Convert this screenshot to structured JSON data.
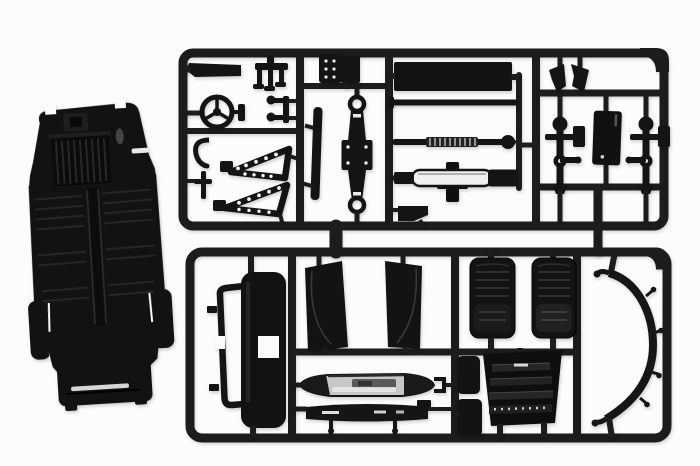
{
  "scene": {
    "type": "product-photo",
    "subject": "black plastic model-kit sprue (parts tree) with a separate chassis floor pan part on the left",
    "background_color": "#fcfcfd",
    "colors": {
      "plastic": "#141414",
      "plastic_deep": "#0c0c0c",
      "runner": "#1c1c1c",
      "panel": "#121212",
      "highlight_grey": "#383838",
      "chrome_base": "#c7c7c7",
      "chrome_streak": "#eaeaea",
      "white_detail": "#e9e9e9",
      "silver_stripe": "#d6d6d6"
    },
    "sprue": {
      "sections": 2,
      "top_section_parts": [
        "exhaust-bar",
        "pedal-cluster",
        "steering-wheel",
        "steering-linkage",
        "wishbone",
        "pin-bracket",
        "a-frame-ladder-1",
        "a-frame-ladder-2",
        "engine-block",
        "side-strip",
        "leaf-spring-axle",
        "side-sill-panel",
        "tie-rod",
        "coil-spring-rod",
        "shock-absorber",
        "mount-bracket",
        "wing-clip-left",
        "wing-clip-right",
        "kingpin-upright-left",
        "kingpin-upright-right",
        "firewall-panel"
      ],
      "bottom_section_parts": [
        "windshield-frame",
        "center-console",
        "door-panel-left",
        "door-panel-right",
        "chrome-bumper",
        "front-valance",
        "bucket-seat-left",
        "bucket-seat-right",
        "radiator-grille",
        "small-panel-top",
        "small-panel-bottom",
        "bumper-arch"
      ]
    },
    "loose_parts": [
      "chassis-floor-pan"
    ]
  }
}
